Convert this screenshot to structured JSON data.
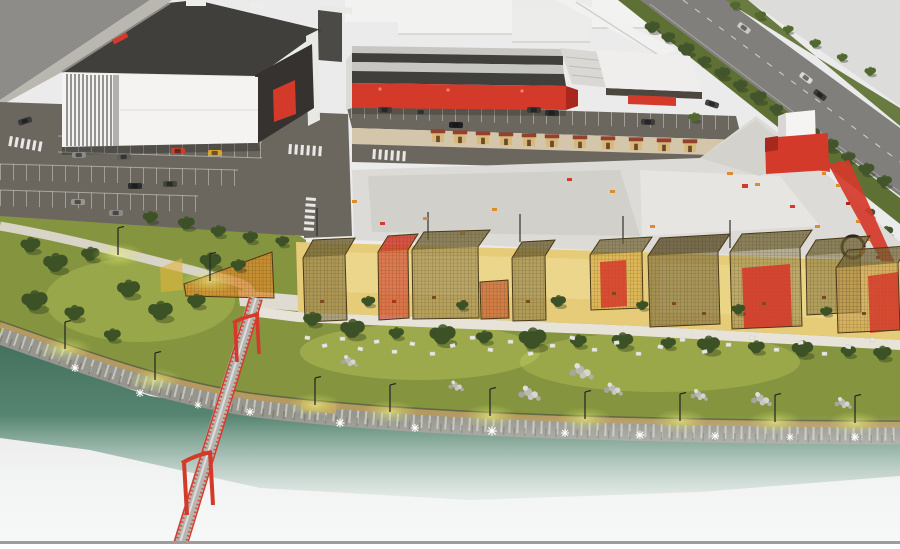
{
  "scene": {
    "type": "architectural-aerial-render",
    "description": "Night-time aerial rendering of a riverside commercial masterplan: a white louvered event hall with dark roof, a long retail hall with red facade, parking lots with cars, a kiosk row, a large paved plaza with a red container pavilion and red walkway, a row of wireframe market pavilions on warm-lit paving, a lamp-lit riverside park with boardwalk and rock embankment, a green river, a red portal-frame pedestrian bridge, and a tree-lined highway crossing the top-right corner.",
    "landmarks": [
      "event-hall",
      "retail-hall",
      "context-buildings",
      "highway",
      "overpass-ramp",
      "parking-lot-west",
      "parking-row-central",
      "kiosk-row",
      "plaza",
      "red-container-kiosk",
      "red-walkway",
      "circular-bench",
      "pavilion-row",
      "park-pavilion-wedge",
      "riverside-lawn",
      "boardwalk",
      "rock-embankment",
      "river",
      "pedestrian-bridge",
      "street-lamps"
    ],
    "counts": {
      "market_pavilions": 11,
      "kiosks": 11,
      "bridge_portals": 2
    }
  },
  "colors": {
    "bg": "#ebebec",
    "contextGray": "#8d8c88",
    "contextWhite": "#f2f2f0",
    "roofDark": "#413f3c",
    "bandLight": "#c6c6c2",
    "facade": "#f4f3f1",
    "red": "#d43a2a",
    "redDeep": "#a9281e",
    "orange": "#df8b2d",
    "yellowFloor": "#e6cc79",
    "kioskTan": "#d9b87c",
    "kioskRoof": "#93402c",
    "asphalt": "#6b675f",
    "plaza": "#dcdbd7",
    "plazaDark": "#cfcec8",
    "sidewalk": "#e7e3d8",
    "grass": "#85943f",
    "grassGlow": "#d8e26e",
    "treeDark": "#3c5226",
    "treeMid": "#51682e",
    "treeRoad": "#42552c",
    "rock": "#96968e",
    "rockLight": "#cdcdc5",
    "boardwalk": "#b49a60",
    "water": "#53806d",
    "deck": "#b5b5b1",
    "border": "#9c9c9a",
    "verge": "#5f7034",
    "roadTop": "#807f7b"
  }
}
